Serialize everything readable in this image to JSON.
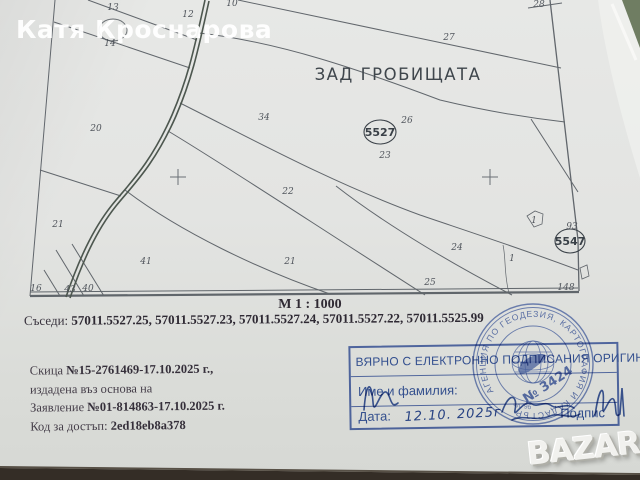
{
  "watermarks": {
    "owner": "Катя Кроснарова",
    "brand": "BAZAR"
  },
  "map": {
    "area_title": "ЗАД ГРОБИЩАТА",
    "scale": "М 1 : 1000",
    "quarter_labels": [
      {
        "label": "5527",
        "x": 380,
        "y": 136,
        "rx": 16,
        "ry": 12
      },
      {
        "label": "5547",
        "x": 570,
        "y": 245,
        "rx": 15,
        "ry": 12
      }
    ],
    "parcels": [
      {
        "label": "13",
        "x": 113,
        "y": 10
      },
      {
        "label": "14",
        "x": 110,
        "y": 46
      },
      {
        "label": "12",
        "x": 188,
        "y": 17
      },
      {
        "label": "10",
        "x": 232,
        "y": 6
      },
      {
        "label": "27",
        "x": 449,
        "y": 40
      },
      {
        "label": "28",
        "x": 539,
        "y": 7
      },
      {
        "label": "20",
        "x": 96,
        "y": 131
      },
      {
        "label": "34",
        "x": 264,
        "y": 120
      },
      {
        "label": "26",
        "x": 407,
        "y": 123
      },
      {
        "label": "23",
        "x": 385,
        "y": 158
      },
      {
        "label": "22",
        "x": 288,
        "y": 194
      },
      {
        "label": "21",
        "x": 58,
        "y": 227
      },
      {
        "label": "41",
        "x": 146,
        "y": 264
      },
      {
        "label": "21",
        "x": 290,
        "y": 264
      },
      {
        "label": "24",
        "x": 457,
        "y": 250
      },
      {
        "label": "25",
        "x": 430,
        "y": 285
      },
      {
        "label": "1",
        "x": 512,
        "y": 261
      },
      {
        "label": "1",
        "x": 534,
        "y": 223
      },
      {
        "label": "93",
        "x": 572,
        "y": 229
      },
      {
        "label": "148",
        "x": 566,
        "y": 290
      },
      {
        "label": "16",
        "x": 36,
        "y": 291
      },
      {
        "label": "43",
        "x": 70,
        "y": 292
      },
      {
        "label": "40",
        "x": 88,
        "y": 291
      }
    ]
  },
  "neighbors": {
    "label": "Съседи:",
    "ids": [
      "57011.5527.25",
      "57011.5527.23",
      "57011.5527.24",
      "57011.5527.22",
      "57011.5525.99"
    ]
  },
  "doc": {
    "sketch_label": "Скица",
    "sketch_number": "№15-2761469-17.10.2025 г.,",
    "based_on": "издадена въз основа на",
    "application_label": "Заявление",
    "application_number": "№01-814863-17.10.2025 г.",
    "access_code_label": "Код за достъп:",
    "access_code": "2ed18eb8a378"
  },
  "stamp_box": {
    "certify_text": "ВЯРНО С ЕЛЕКТРОННО ПОДПИСАНИЯ ОРИГИНАЛ",
    "name_label": "Име и фамилия:",
    "date_label": "Дата:",
    "date_value": "12.10. 2025г",
    "signature_label": "Подпис"
  },
  "round_stamp": {
    "agency_arc": "АГЕНЦИЯ ПО ГЕОДЕЗИЯ, КАРТОГРАФИЯ И КАДАСТЪР",
    "number": "№ 3424",
    "note": "чл. 9б"
  },
  "colors": {
    "paper": "#e3e4e2",
    "map_ink": "#4b5158",
    "road_ink": "#4d574f",
    "doc_ink": "#453e49",
    "stamp_blue": "#3c5ca8",
    "table_edge_dark": "#342d26",
    "background_green": "#6f7d62"
  }
}
